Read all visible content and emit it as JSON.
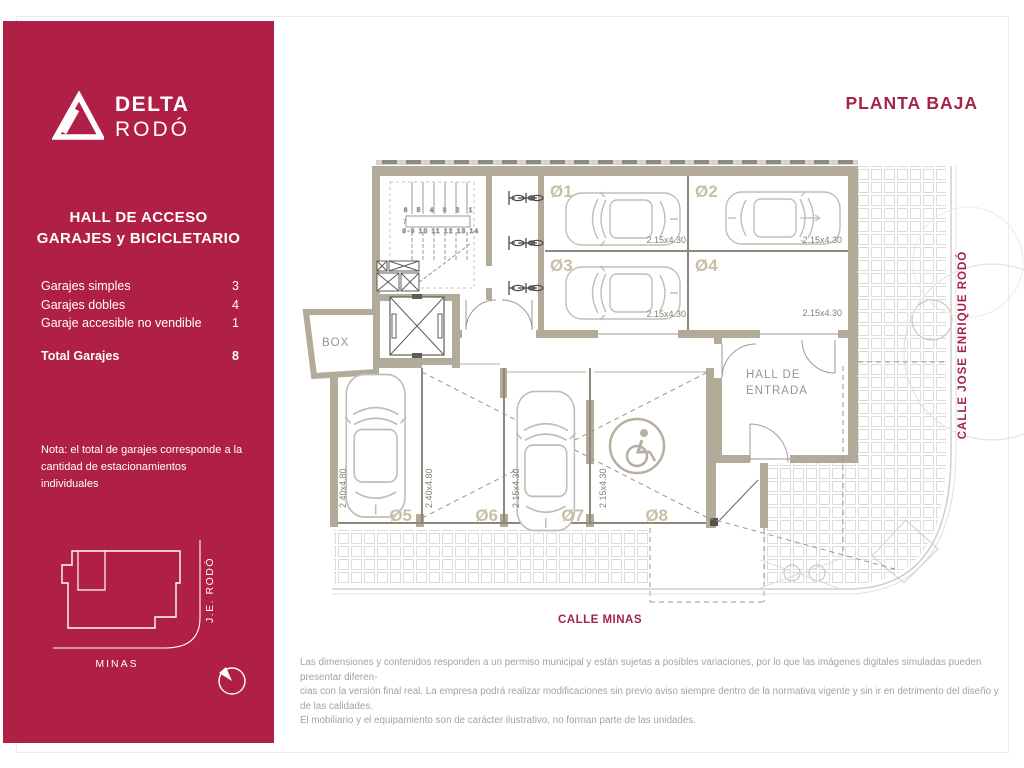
{
  "colors": {
    "brand_red": "#b01f45",
    "accent_text": "#a52347",
    "wall_tan": "#b2ab9a"
  },
  "sidebar": {
    "brand": {
      "line1": "DELTA",
      "line2": "RODÓ"
    },
    "title1": "HALL DE ACCESO",
    "title2": "GARAJES y BICICLETARIO",
    "stats": [
      {
        "label": "Garajes simples",
        "value": "3"
      },
      {
        "label": "Garajes dobles",
        "value": "4"
      },
      {
        "label": "Garaje accesible no vendible",
        "value": "1"
      }
    ],
    "total": {
      "label": "Total Garajes",
      "value": "8"
    },
    "note1": "Nota: el total de garajes corresponde a la",
    "note2": "cantidad de estacionamientos individuales",
    "minimap": {
      "street_bottom": "MINAS",
      "street_right": "J.E. RODÓ"
    }
  },
  "plan": {
    "title": "PLANTA BAJA",
    "streets": {
      "bottom": "CALLE MINAS",
      "right": "CALLE JOSE ENRIQUE RODÓ"
    },
    "rooms": {
      "box": "BOX",
      "hall1": "HALL DE",
      "hall2": "ENTRADA"
    },
    "stairs": {
      "top_row": "6 5 4 3 2 1",
      "mid": "7",
      "bottom_row": "8·9 10 11 12 13 14"
    },
    "garages": [
      {
        "id": "Ø1",
        "dim": "2.15x4.30"
      },
      {
        "id": "Ø2",
        "dim": "2.15x4.30"
      },
      {
        "id": "Ø3",
        "dim": "2.15x4.30"
      },
      {
        "id": "Ø4",
        "dim": "2.15x4.30"
      },
      {
        "id": "Ø5",
        "dim": "2.40x4.80"
      },
      {
        "id": "Ø6",
        "dim": "2.40x4.80"
      },
      {
        "id": "Ø7",
        "dim": "2.15x4.30"
      },
      {
        "id": "Ø8",
        "dim": "2.15x4.30"
      }
    ]
  },
  "footer": {
    "line1": "Las dimensiones y contenidos responden a un permiso municipal y están sujetas a posibles variaciones, por lo que las imágenes digitales simuladas pueden presentar diferen-",
    "line2": "cias con la versión final real. La empresa podrá realizar modificaciones sin previo aviso siempre dentro de la normativa vigente y sin ir en detrimento del diseño y de las calidades.",
    "line3": "El mobiliario y el equipamiento  son de carácter ilustrativo, no forman parte de las unidades."
  }
}
